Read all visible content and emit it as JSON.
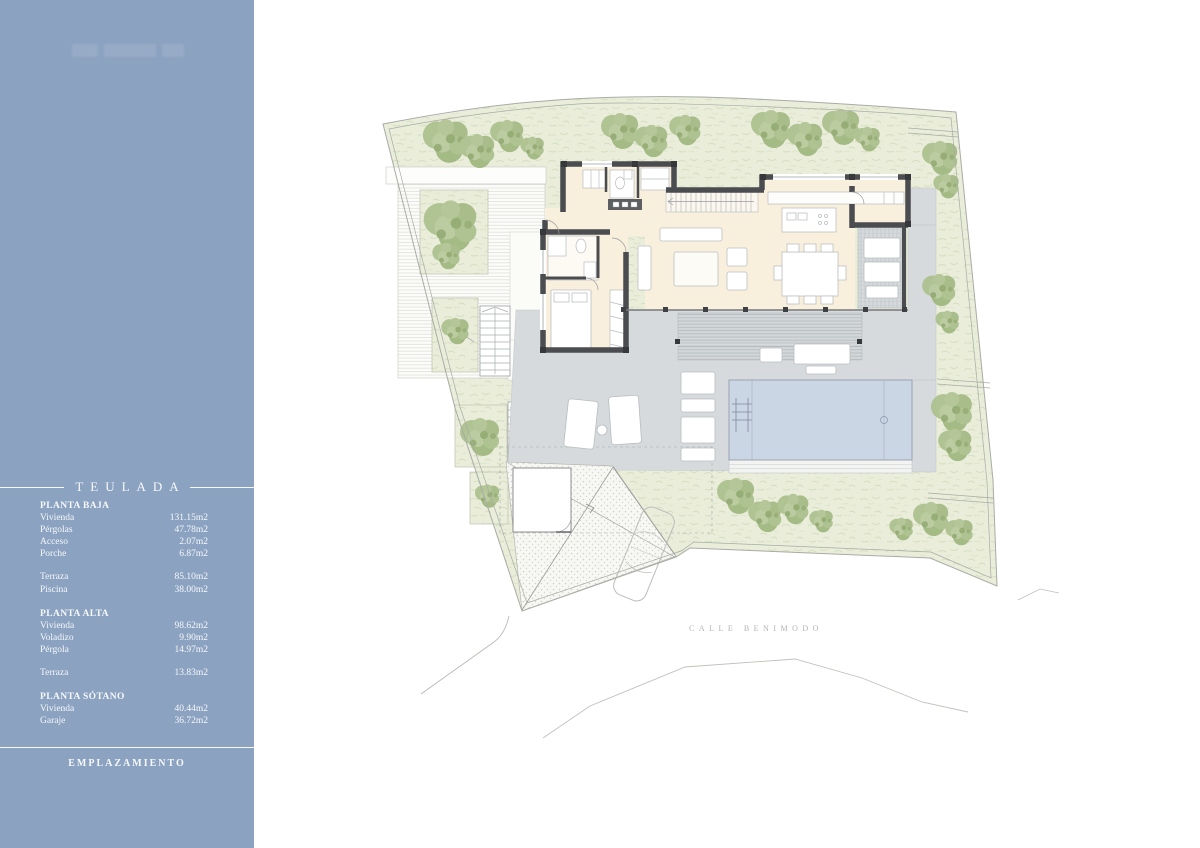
{
  "sidebar": {
    "title": "TEULADA",
    "footer": "EMPLAZAMIENTO",
    "sections": {
      "baja": {
        "title": "PLANTA BAJA",
        "rows": [
          {
            "label": "Vivienda",
            "value": "131.15m2"
          },
          {
            "label": "Pérgolas",
            "value": "47.78m2"
          },
          {
            "label": "Acceso",
            "value": "2.07m2"
          },
          {
            "label": "Porche",
            "value": "6.87m2"
          },
          {
            "label": "Terraza",
            "value": "85.10m2"
          },
          {
            "label": "Piscina",
            "value": "38.00m2"
          }
        ]
      },
      "alta": {
        "title": "PLANTA ALTA",
        "rows": [
          {
            "label": "Vivienda",
            "value": "98.62m2"
          },
          {
            "label": "Voladizo",
            "value": "9.90m2"
          },
          {
            "label": "Pérgola",
            "value": "14.97m2"
          },
          {
            "label": "Terraza",
            "value": "13.83m2"
          }
        ]
      },
      "sotano": {
        "title": "PLANTA SÓTANO",
        "rows": [
          {
            "label": "Vivienda",
            "value": "40.44m2"
          },
          {
            "label": "Garaje",
            "value": "36.72m2"
          }
        ]
      }
    }
  },
  "plan": {
    "street_label": "CALLE BENIMODO"
  },
  "colors": {
    "sidebar_blue": "#8BA2C0",
    "wall_dark": "#4B4C4F",
    "interior_cream": "#F8EFDC",
    "pool_blue": "#CBD6E5",
    "terrace_gray": "#D7DADC",
    "garden_green": "#E9EDDA",
    "tree_green": "#A6BC89",
    "boundary_line": "#A8ACA6",
    "street_text": "#B3B3B3"
  }
}
